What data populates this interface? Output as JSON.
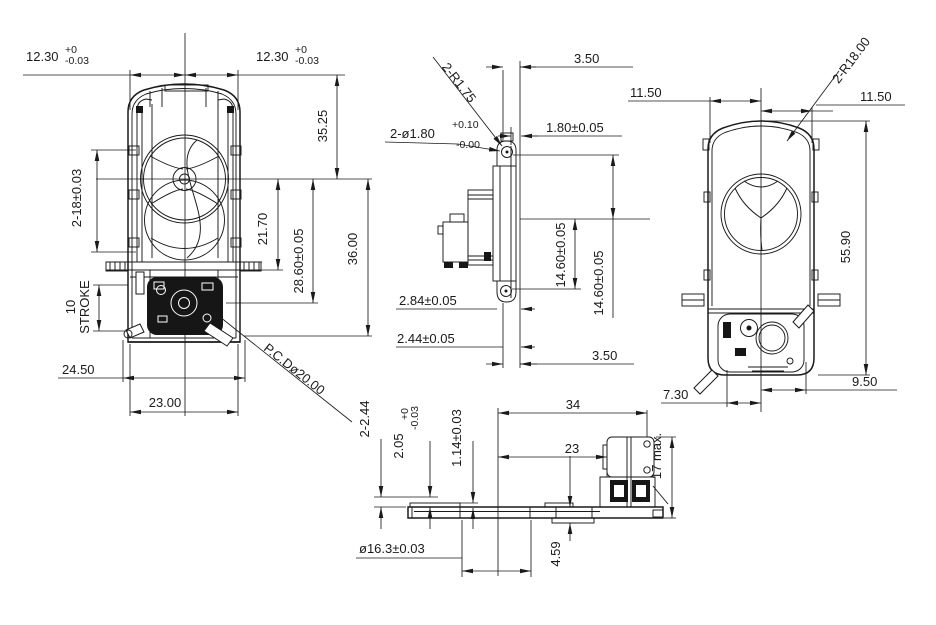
{
  "colors": {
    "line": "#1a1a1a",
    "background": "#ffffff"
  },
  "labels": {
    "front": {
      "w_left": "12.30",
      "w_left_up": "+0",
      "w_left_dn": "-0.03",
      "w_right": "12.30",
      "w_right_up": "+0",
      "w_right_dn": "-0.03",
      "h3525": "35.25",
      "rail": "2-18±0.03",
      "d2170": "21.70",
      "d2860": "28.60±0.05",
      "d3600": "36.00",
      "stroke_val": "10",
      "stroke_word": "STROKE",
      "d2450": "24.50",
      "d2300": "23.00",
      "pcd": "P.C.Dø20.00"
    },
    "side": {
      "t350": "3.50",
      "r175": "2-R1.75",
      "hole": "2-ø1.80",
      "hole_up": "+0.10",
      "hole_dn": "-0.00",
      "d180": "1.80±0.05",
      "d1460a": "14.60±0.05",
      "d1460b": "14.60±0.05",
      "d284": "2.84±0.05",
      "d244": "2.44±0.05",
      "b350": "3.50"
    },
    "rear": {
      "w_left": "11.50",
      "w_right": "11.50",
      "r18": "2-R18.00",
      "h5590": "55.90",
      "d730": "7.30",
      "d950": "9.50"
    },
    "bottom": {
      "d244": "2-2.44",
      "d205": "2.05",
      "d205_up": "+0",
      "d205_dn": "-0.03",
      "d114": "1.14±0.03",
      "d34": "34",
      "d23": "23",
      "d17": "17 max.",
      "d459": "4.59",
      "dia163": "ø16.3±0.03"
    }
  }
}
